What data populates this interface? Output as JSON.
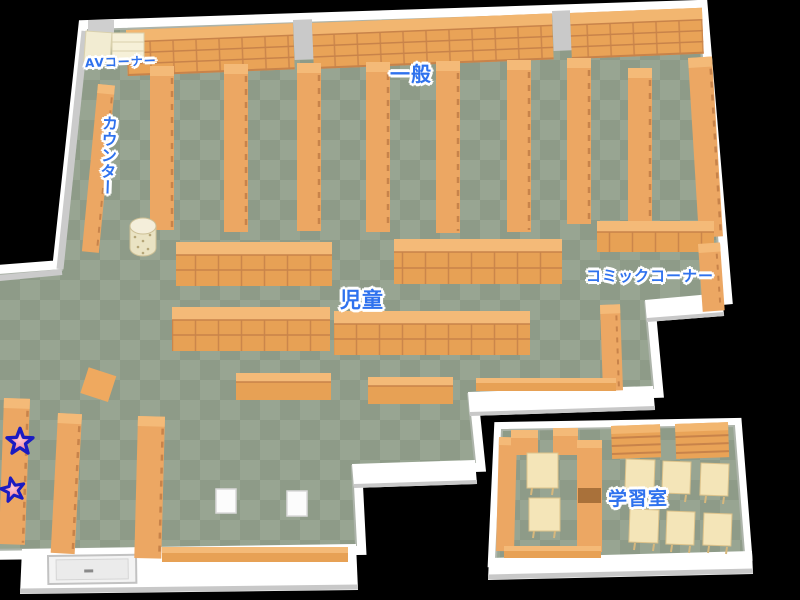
{
  "map": {
    "areas": {
      "av_corner": "AVコーナー",
      "general": "一般",
      "counter": "カウンター",
      "children": "児童",
      "comic_corner": "コミックコーナー",
      "study_room": "学習室"
    },
    "markers": [
      {
        "name": "star-marker-1",
        "icon": "star-icon"
      },
      {
        "name": "star-marker-2",
        "icon": "star-icon"
      }
    ],
    "colors": {
      "background": "#000000",
      "floor_dark": "#8E9B88",
      "floor_light": "#98A592",
      "wall": "#FFFFFF",
      "wall_shadow": "#C9C9C9",
      "shelf": "#ECA763",
      "shelf_top": "#F4BA78",
      "shelf_line": "#C8834A",
      "desk": "#F4E5B8",
      "av_unit": "#F4EDD3",
      "label_text": "#2F72EE",
      "label_outline": "#FFFFFF",
      "star_fill": "#F58CA0",
      "star_outline": "#1B1BC2"
    }
  }
}
